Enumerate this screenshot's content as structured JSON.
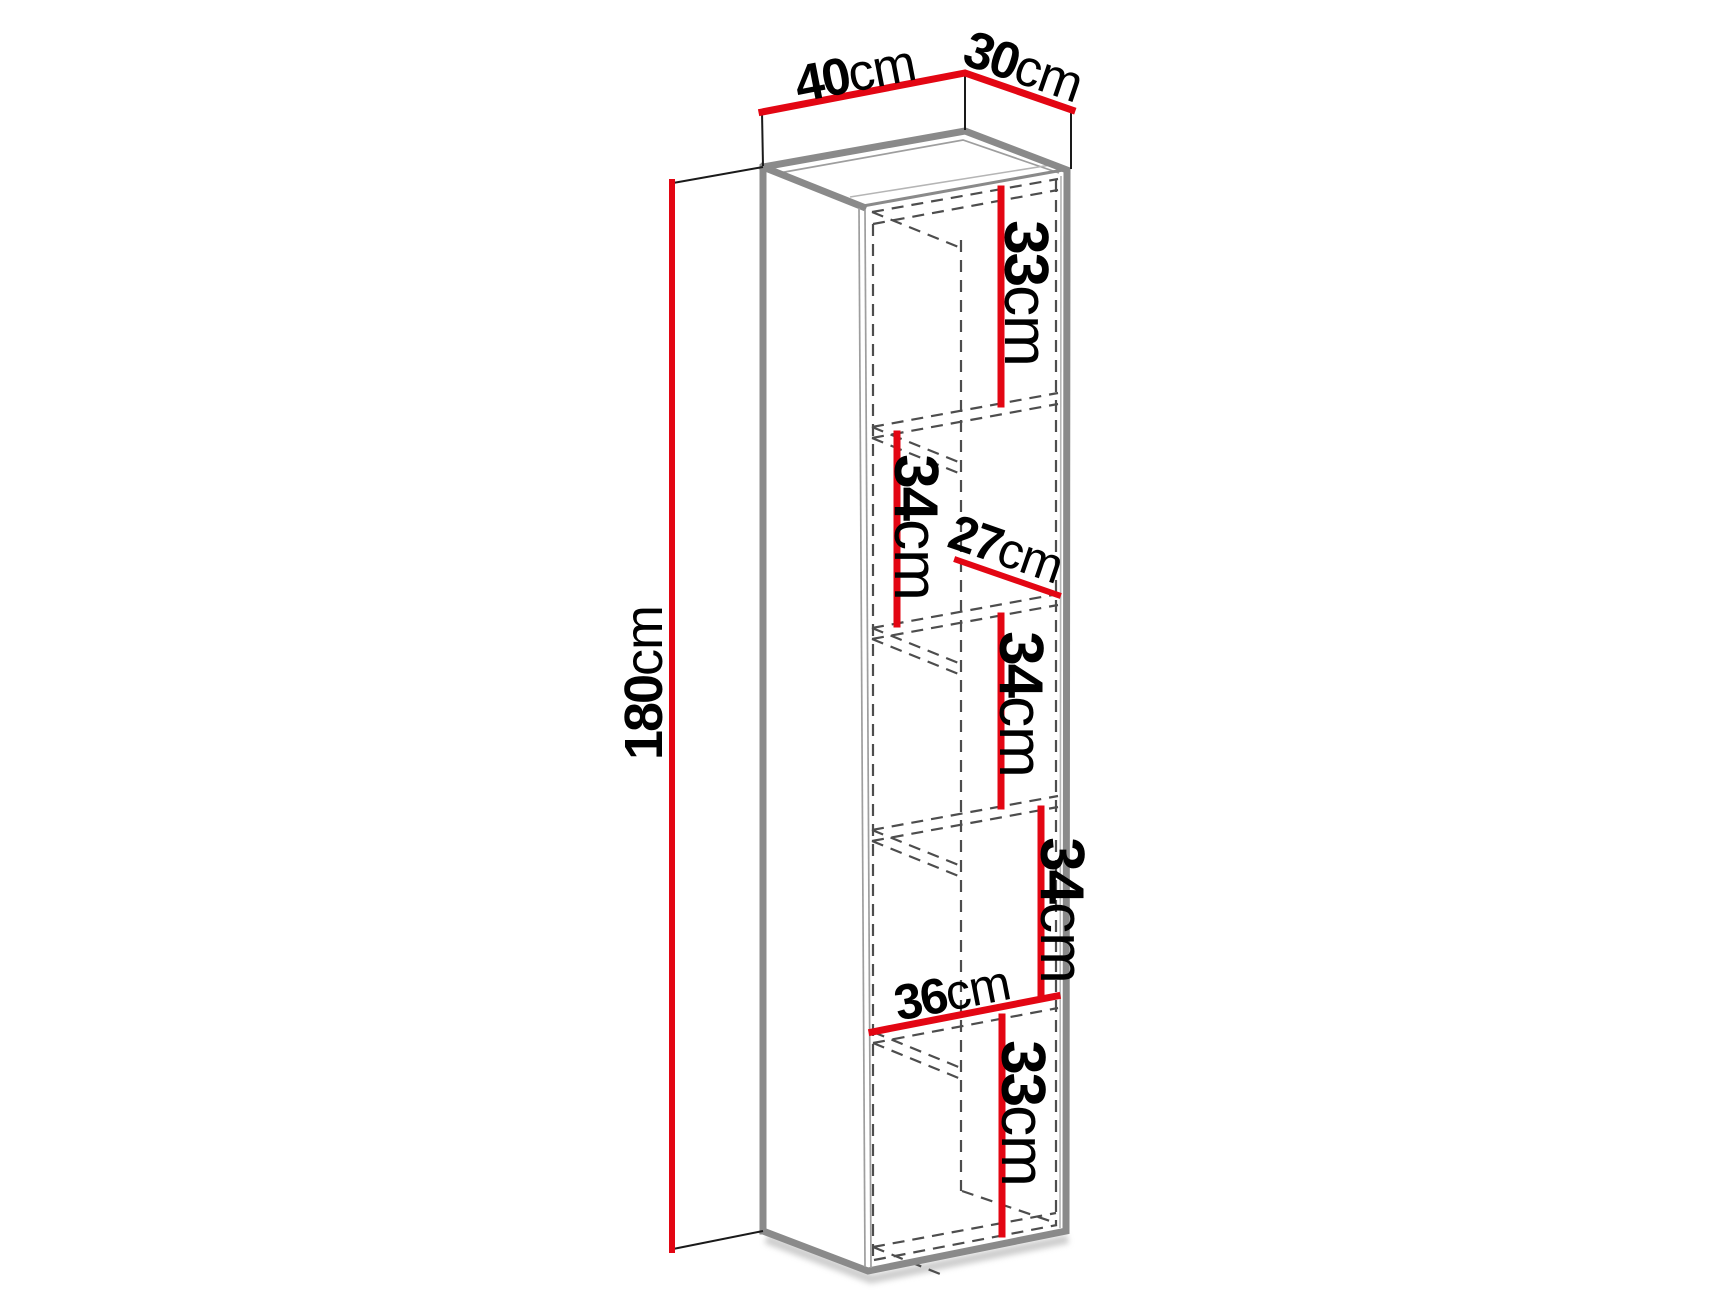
{
  "diagram": {
    "type": "furniture-dimension-drawing",
    "background": "#ffffff",
    "colors": {
      "dimension_line": "#e30613",
      "cabinet_edge": "#8a8a8a",
      "hidden_line": "#4d4d4d",
      "extension_line": "#1a1a1a",
      "label_text": "#000000"
    },
    "labels": {
      "width": {
        "value": "40",
        "unit": "cm"
      },
      "depth": {
        "value": "30",
        "unit": "cm"
      },
      "height": {
        "value": "180",
        "unit": "cm"
      },
      "compartment_1": {
        "value": "33",
        "unit": "cm"
      },
      "compartment_2": {
        "value": "34",
        "unit": "cm"
      },
      "shelf_depth": {
        "value": "27",
        "unit": "cm"
      },
      "compartment_3": {
        "value": "34",
        "unit": "cm"
      },
      "compartment_4": {
        "value": "34",
        "unit": "cm"
      },
      "bottom_shelf_width": {
        "value": "36",
        "unit": "cm"
      },
      "compartment_5": {
        "value": "33",
        "unit": "cm"
      }
    }
  }
}
